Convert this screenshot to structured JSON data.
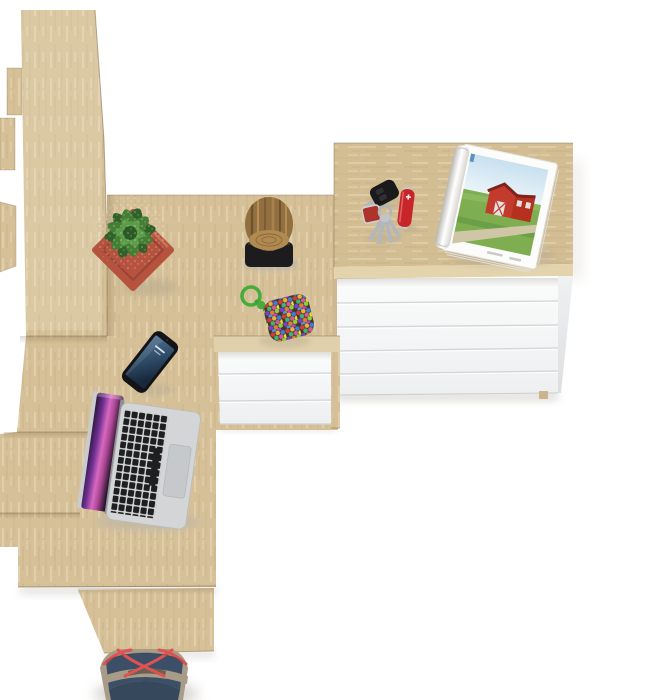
{
  "meta": {
    "title": "Top-down render of an oak corner desk with shelf column, white drawer pedestal and five-drawer chest",
    "canvas": {
      "width": 650,
      "height": 700
    },
    "background": "#ffffff"
  },
  "palette": {
    "oak": "#d6c098",
    "oak_dark_edge": "#a88c60",
    "oak_front_band": "#e3d4ae",
    "drawer_white_top": "#fbfcfc",
    "drawer_white_bottom": "#eef0f1",
    "drawer_groove": "#d2d5d8",
    "pot_terracotta": "#b5533f",
    "plant_green_dark": "#2f6128",
    "plant_green_light": "#6fae5b",
    "stool_wood": "#9c7747",
    "stool_base_black": "#1c1c1e",
    "keychain_cord_green": "#46ad3c",
    "phone_black": "#141416",
    "phone_screen_blue": "#33516e",
    "laptop_silver": "#d3d5d7",
    "laptop_key_black": "#1e1f21",
    "laptop_screen_magenta": "#d868c0",
    "knife_red": "#c8252b",
    "magazine_sky": "#cfe4f1",
    "magazine_grass": "#7fae51",
    "magazine_barn_red": "#c23b2d",
    "bag_navy": "#3c4f66",
    "bag_taupe": "#a89b87",
    "bag_strap_red": "#e05252",
    "floor_shadow": "#c9c6c0"
  },
  "counts": {
    "chest_drawers": 5,
    "pedestal_drawers": 3,
    "keys_on_ring": 4
  },
  "objects": [
    {
      "id": "bookshelf-column",
      "label": "Tall oak shelf column seen from above with stepped side boards"
    },
    {
      "id": "desk-surface",
      "label": "Oak desk top surface"
    },
    {
      "id": "desk-drawer-unit",
      "label": "White under-desk drawer pedestal with three drawers"
    },
    {
      "id": "drawer-chest",
      "label": "Chest with oak top and five white drawers"
    },
    {
      "id": "potted-plant",
      "label": "Speckled green plant in square terracotta pot"
    },
    {
      "id": "log-stool",
      "label": "Natural wood log stool on black base"
    },
    {
      "id": "beaded-keychain",
      "label": "Green paracord keychain with multicolored beaded pouch"
    },
    {
      "id": "smartphone",
      "label": "Black smartphone with blue lock screen"
    },
    {
      "id": "laptop",
      "label": "Open silver laptop with purple wallpaper, keyboard and trackpad"
    },
    {
      "id": "car-key-fob",
      "label": "Black car key fob with metal blade"
    },
    {
      "id": "key-bunch",
      "label": "Key ring with four keys and red tag"
    },
    {
      "id": "pocket-knife",
      "label": "Red pocket knife"
    },
    {
      "id": "magazine",
      "label": "Open rolled magazine showing a red barn in a green field"
    },
    {
      "id": "tote-bag",
      "label": "Navy and taupe tote bag with red cord straps"
    }
  ]
}
